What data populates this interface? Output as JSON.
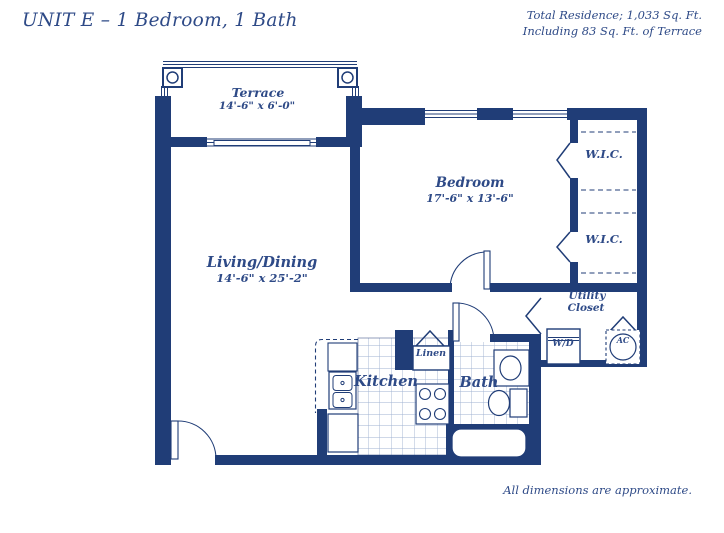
{
  "page": {
    "title": "UNIT E – 1 Bedroom, 1 Bath",
    "residence_line1": "Total Residence; 1,033 Sq. Ft.",
    "residence_line2": "Including 83 Sq. Ft. of Terrace",
    "footnote": "All dimensions are approximate."
  },
  "rooms": {
    "terrace": {
      "name": "Terrace",
      "dims": "14'-6\" x 6'-0\""
    },
    "living": {
      "name": "Living/Dining",
      "dims": "14'-6\" x 25'-2\""
    },
    "bedroom": {
      "name": "Bedroom",
      "dims": "17'-6\" x 13'-6\""
    },
    "kitchen": {
      "name": "Kitchen"
    },
    "bath": {
      "name": "Bath"
    },
    "linen": {
      "name": "Linen"
    },
    "utility": {
      "name_line1": "Utility",
      "name_line2": "Closet"
    },
    "wic_upper": {
      "name": "W.I.C."
    },
    "wic_lower": {
      "name": "W.I.C."
    },
    "washer_dryer": {
      "name": "W/D"
    },
    "ac_unit": {
      "name": "AC"
    }
  },
  "colors": {
    "wall": "#203D77",
    "text": "#2E4A87",
    "tile": "#9FB2D2"
  }
}
